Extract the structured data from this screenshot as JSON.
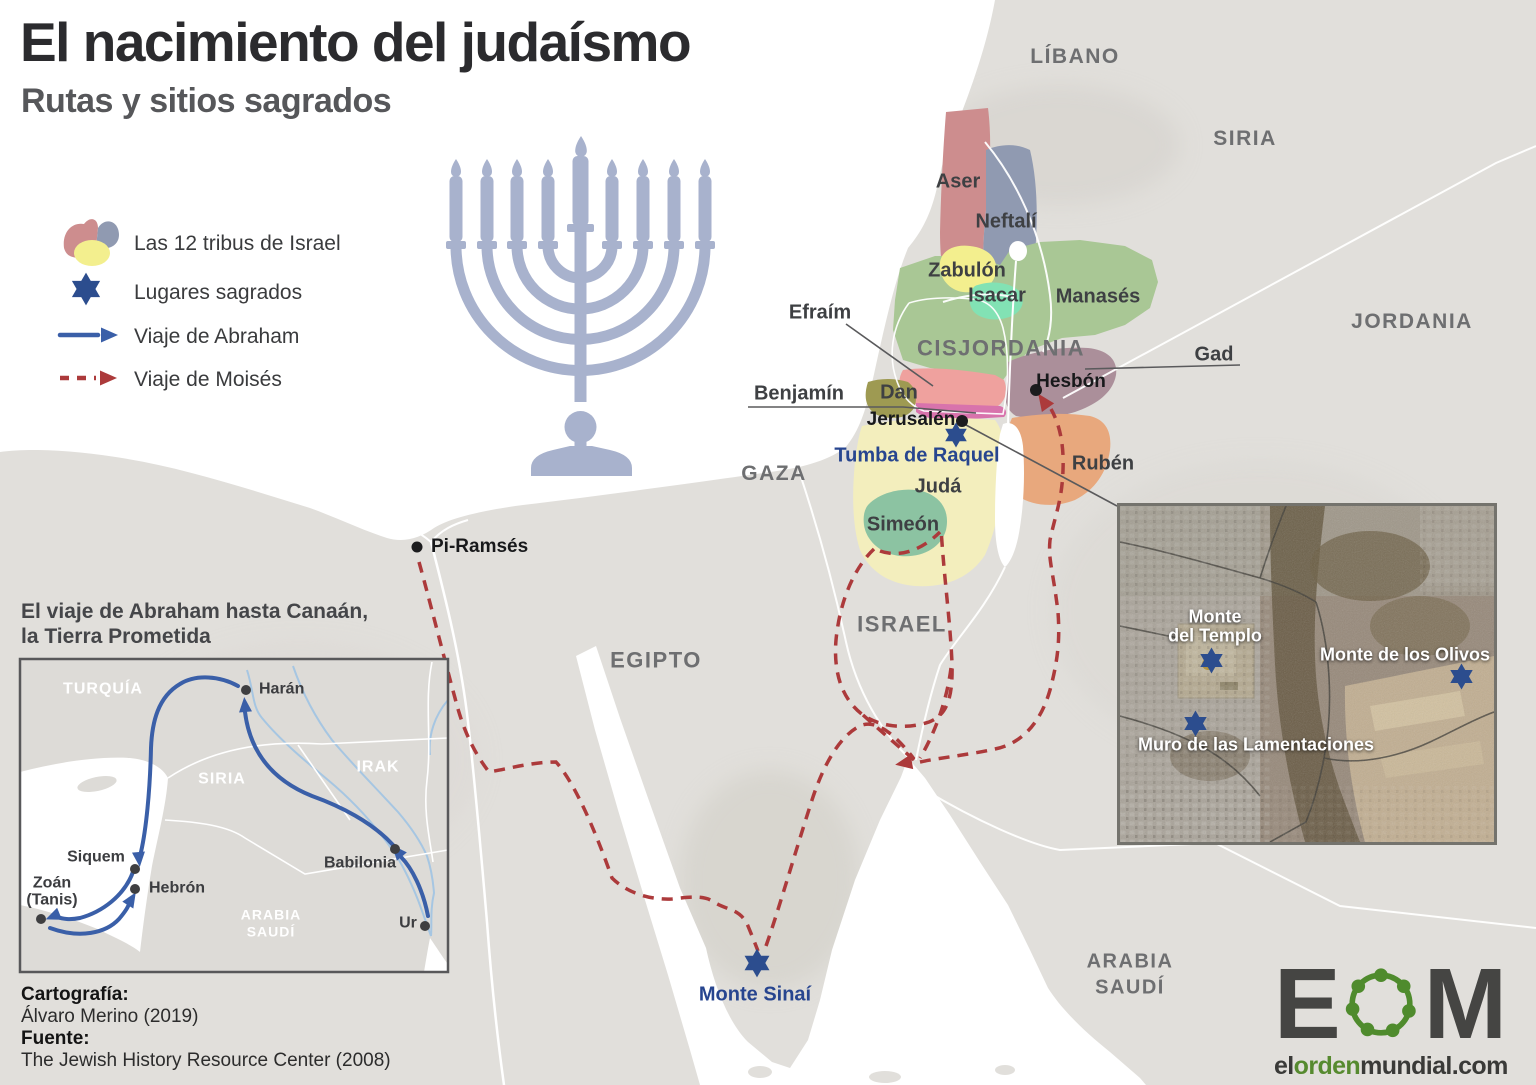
{
  "title": "El nacimiento del judaísmo",
  "subtitle": "Rutas y sitios sagrados",
  "legend": {
    "tribes": "Las 12 tribus de Israel",
    "sacred": "Lugares sagrados",
    "abraham": "Viaje de Abraham",
    "moses": "Viaje de Moisés"
  },
  "countries": {
    "libano": "LÍBANO",
    "siria": "SIRIA",
    "jordania": "JORDANIA",
    "cisjordania": "CISJORDANIA",
    "gaza": "GAZA",
    "egipto": "EGIPTO",
    "israel": "ISRAEL",
    "arabia_line1": "ARABIA",
    "arabia_line2": "SAUDÍ"
  },
  "tribes": {
    "aser": "Aser",
    "neftali": "Neftalí",
    "zabulon": "Zabulón",
    "isacar": "Isacar",
    "manases": "Manasés",
    "efraim": "Efraím",
    "gad": "Gad",
    "dan": "Dan",
    "benjamin": "Benjamín",
    "ruben": "Rubén",
    "juda": "Judá",
    "simeon": "Simeón"
  },
  "cities": {
    "jerusalen": "Jerusalén",
    "hesbon": "Hesbón",
    "piramses": "Pi-Ramsés"
  },
  "sacred_sites": {
    "tumba": "Tumba de Raquel",
    "sinai": "Monte Sinaí"
  },
  "inset": {
    "title_line1": "El viaje de Abraham hasta Canaán,",
    "title_line2": "la Tierra Prometida",
    "regions": {
      "turquia": "TURQUÍA",
      "siria": "SIRIA",
      "irak": "IRAK",
      "arabia_line1": "ARABIA",
      "arabia_line2": "SAUDÍ"
    },
    "cities": {
      "haran": "Harán",
      "siquem": "Siquem",
      "zoan_line1": "Zoán",
      "zoan_line2": "(Tanis)",
      "hebron": "Hebrón",
      "babilonia": "Babilonia",
      "ur": "Ur"
    }
  },
  "satellite": {
    "temple_line1": "Monte",
    "temple_line2": "del Templo",
    "olives": "Monte de los Olivos",
    "wall": "Muro de las Lamentaciones"
  },
  "credits": {
    "carto_label": "Cartografía:",
    "carto_value": "Álvaro Merino (2019)",
    "source_label": "Fuente:",
    "source_value": "The Jewish History Resource Center (2008)"
  },
  "logo": {
    "letter_e": "E",
    "letter_m": "M",
    "url_el": "el",
    "url_orden": "orden",
    "url_rest": "mundial.com"
  },
  "colors": {
    "sea": "#ffffff",
    "land": "#e1dfdb",
    "menorah": "#a8b2cd",
    "sacred_star": "#2c4d8e",
    "moses_route": "#ac3a3b",
    "abraham_route": "#3a5fa8",
    "tribe_aser": "#cd8d8e",
    "tribe_neftali": "#909ab1",
    "tribe_zabulon": "#f3ef8e",
    "tribe_isacar": "#82e2b4",
    "tribe_manases": "#a9c795",
    "tribe_efraim": "#efa19e",
    "tribe_dan": "#9e9a52",
    "tribe_benjamin": "#d873ac",
    "tribe_gad": "#ab8f9a",
    "tribe_ruben": "#e8a87d",
    "tribe_juda": "#f3eebd",
    "tribe_simeon": "#8cc3a2",
    "logo_green": "#4f8b2d"
  }
}
